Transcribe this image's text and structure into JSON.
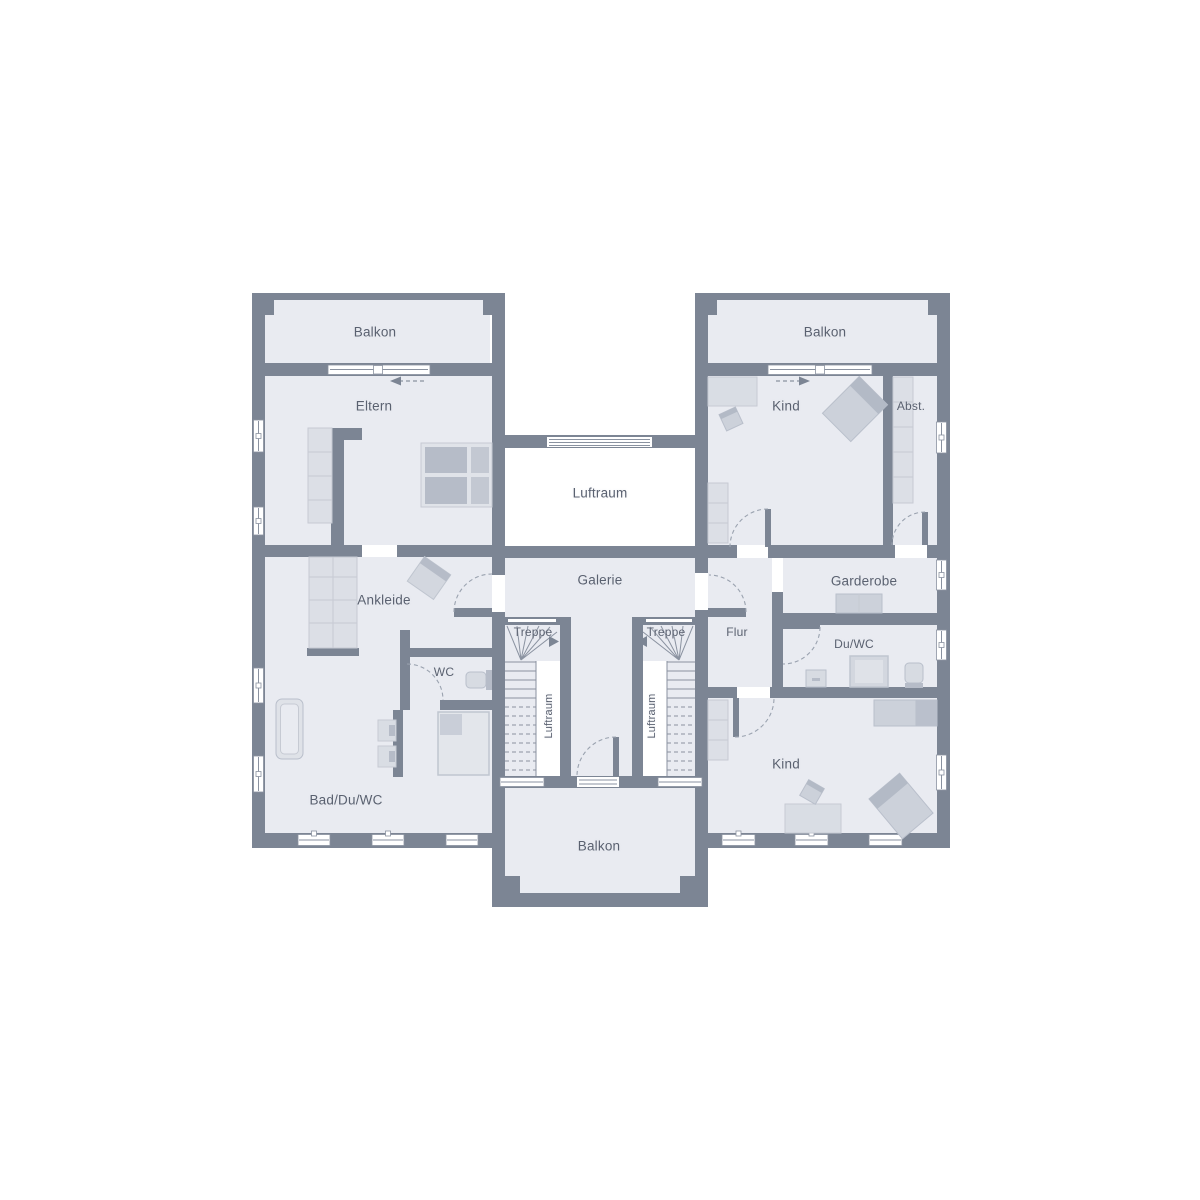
{
  "colors": {
    "wall": "#7c8594",
    "floor": "#e9ebf1",
    "furn": "#d9dde4",
    "furnd": "#b6bcc8",
    "line": "#c6cad3",
    "text": "#5a6170"
  },
  "labels": {
    "balkon_top_left": "Balkon",
    "balkon_top_right": "Balkon",
    "balkon_bottom": "Balkon",
    "eltern": "Eltern",
    "kind_top": "Kind",
    "kind_bottom": "Kind",
    "abst": "Abst.",
    "luftraum": "Luftraum",
    "luftraum_stair_left": "Luftraum",
    "luftraum_stair_right": "Luftraum",
    "galerie": "Galerie",
    "ankleide": "Ankleide",
    "garderobe": "Garderobe",
    "treppe_left": "Treppe",
    "treppe_right": "Treppe",
    "flur": "Flur",
    "wc": "WC",
    "du_wc": "Du/WC",
    "bad_du_wc": "Bad/Du/WC"
  }
}
